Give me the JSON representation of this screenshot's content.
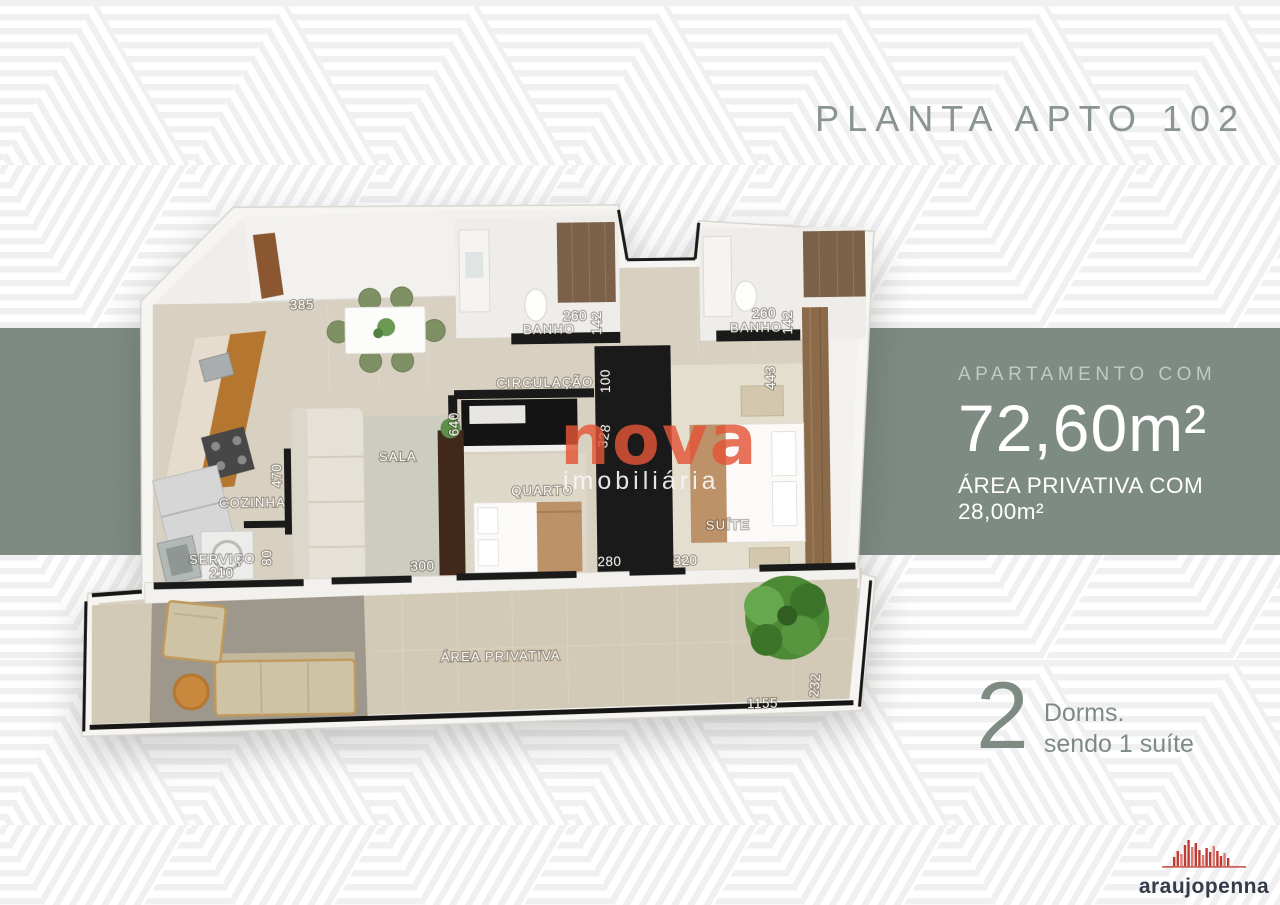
{
  "title": "PLANTA APTO 102",
  "panel": {
    "line1": "APARTAMENTO COM",
    "area": "72,60m²",
    "line2": "ÁREA PRIVATIVA COM 28,00m²"
  },
  "dorms": {
    "count": "2",
    "label": "Dorms.",
    "sublabel": "sendo 1 suíte"
  },
  "watermark": {
    "name": "nova",
    "tagline": "imobiliária"
  },
  "logo": {
    "name": "araujopenna"
  },
  "colors": {
    "band_green": "#7d8b83",
    "title_gray_green": "#8a958f",
    "watermark_red": "#e3563c",
    "logo_red": "#c23b33",
    "logo_dark": "#343b49",
    "floor_beige": "#d8d0c1",
    "wall_black": "#1a1a1a",
    "chair_green": "#7e9064"
  },
  "rooms": [
    {
      "label": "BANHO"
    },
    {
      "label": "BANHO"
    },
    {
      "label": "CIRCULAÇÃO"
    },
    {
      "label": "COZINHA"
    },
    {
      "label": "SALA"
    },
    {
      "label": "QUARTO"
    },
    {
      "label": "SUÍTE"
    },
    {
      "label": "SERVIÇO"
    },
    {
      "label": "ÁREA PRIVATIVA"
    }
  ],
  "dims": [
    {
      "value": "385"
    },
    {
      "value": "260"
    },
    {
      "value": "142"
    },
    {
      "value": "100"
    },
    {
      "value": "260"
    },
    {
      "value": "142"
    },
    {
      "value": "443"
    },
    {
      "value": "640"
    },
    {
      "value": "328"
    },
    {
      "value": "470"
    },
    {
      "value": "80"
    },
    {
      "value": "210"
    },
    {
      "value": "300"
    },
    {
      "value": "280"
    },
    {
      "value": "320"
    },
    {
      "value": "1155"
    },
    {
      "value": "232"
    }
  ]
}
